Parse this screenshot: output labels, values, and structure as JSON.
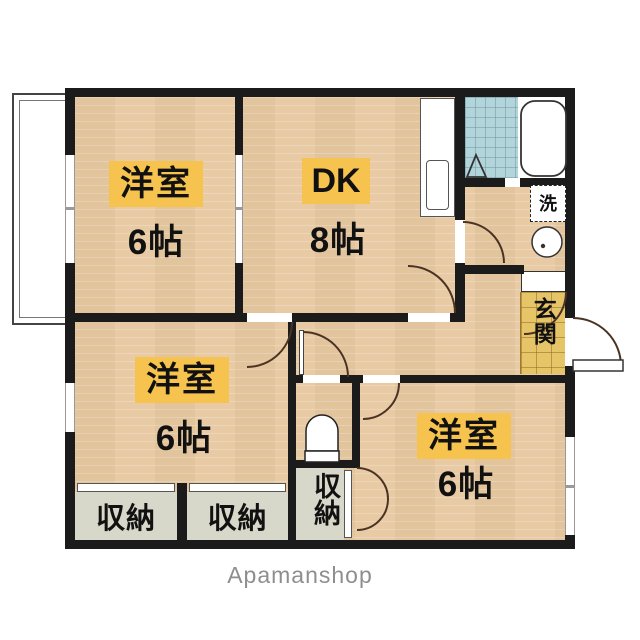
{
  "floorplan": {
    "rooms": [
      {
        "name": "洋室",
        "size": "6帖",
        "position": "top-left"
      },
      {
        "name": "DK",
        "size": "8帖",
        "position": "top-center"
      },
      {
        "name": "洋室",
        "size": "6帖",
        "position": "bottom-left"
      },
      {
        "name": "洋室",
        "size": "6帖",
        "position": "bottom-right"
      }
    ],
    "spaces": {
      "entrance": "玄関",
      "laundry": "洗",
      "closet_sw_left": "収納",
      "closet_sw_right": "収納",
      "closet_center": "収納"
    },
    "watermark": "Apamanshop",
    "colors": {
      "floor": "#e8cba4",
      "label_bg": "#f6c44e",
      "bath_tile": "#b2d5dc",
      "genkan_tile": "#e6c468",
      "closet_bg": "#d8d8ca",
      "wall": "#1b1b1b"
    }
  }
}
